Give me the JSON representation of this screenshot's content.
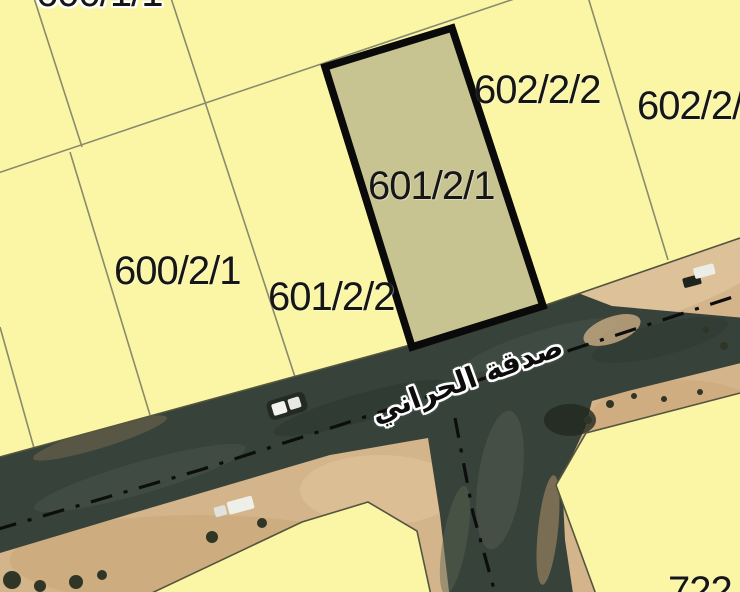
{
  "map": {
    "type": "cadastral-parcel-map-over-satellite",
    "parcel_labels": {
      "top_partial": "600/1/1",
      "p602_2_2": "602/2/2",
      "p602_2_right_partial": "602/2/",
      "p601_2_1": "601/2/1",
      "p600_2_1": "600/2/1",
      "p601_2_2": "601/2/2",
      "p722_partial": "722"
    },
    "highlighted_parcel": "601/2/1",
    "street_name": "صدقة الحراني",
    "colors": {
      "parcel_fill": "#FAF6A5",
      "highlight_fill": "#C8C492",
      "highlight_border": "#0A0A0A",
      "boundary_line": "#8A8A6D",
      "road_boundary_line": "#55553F",
      "road_asphalt": "#37423A",
      "sand": "#D4B48A",
      "centerline": "#0D0D0D",
      "label_text": "#161616"
    }
  }
}
